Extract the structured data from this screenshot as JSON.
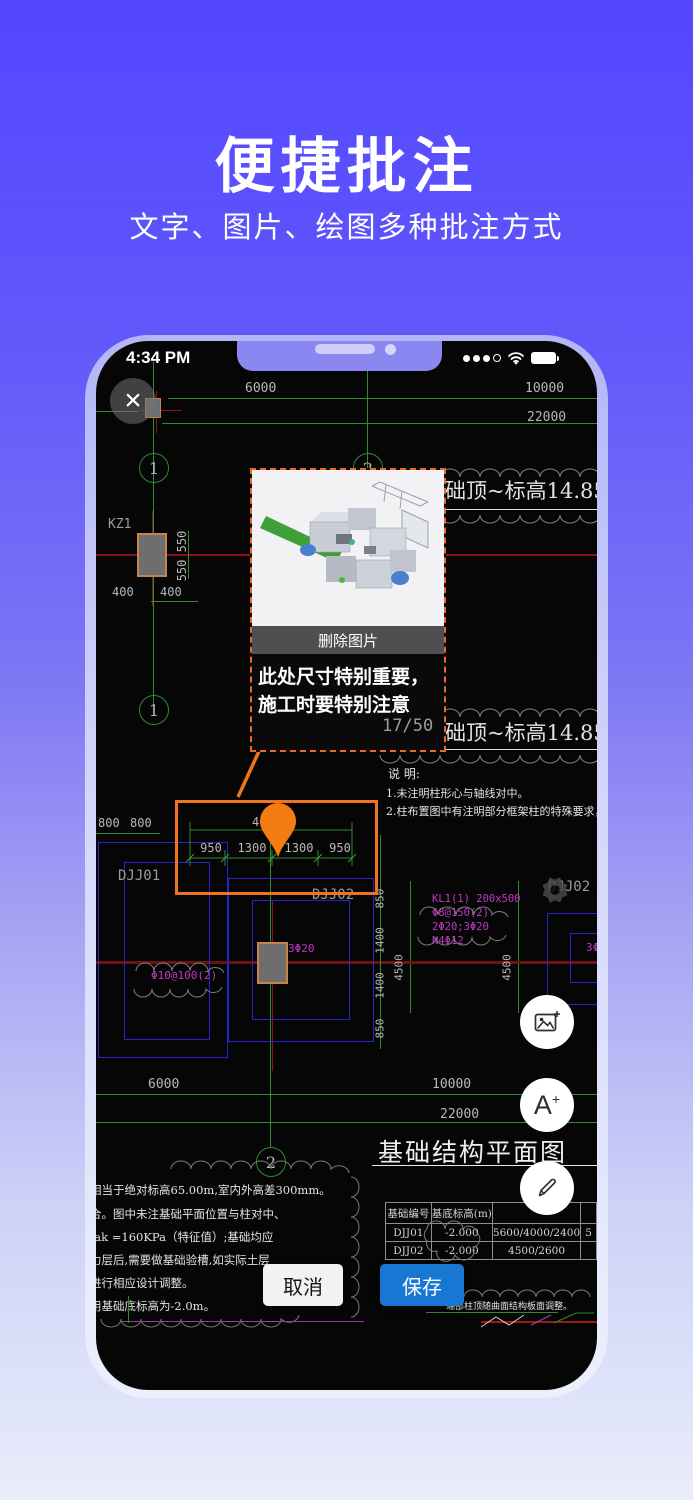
{
  "hero": {
    "title": "便捷批注",
    "subtitle": "文字、图片、绘图多种批注方式"
  },
  "status": {
    "time": "4:34 PM"
  },
  "viewer": {
    "page_indicator": "17/50"
  },
  "popup": {
    "delete_label": "删除图片",
    "note_line1": "此处尺寸特别重要，",
    "note_line2": "施工时要特别注意"
  },
  "actions": {
    "cancel_label": "取消",
    "save_label": "保存"
  },
  "fab": {
    "add_text_a": "A",
    "add_text_plus": "+"
  },
  "cad": {
    "top_dim_1": "6000",
    "top_dim_2": "10000",
    "top_dim_3": "22000",
    "grid_label_1": "1",
    "grid_label_2": "2",
    "kz1_label": "KZ1",
    "dim_550": "550 550",
    "dim_400_l": "400",
    "dim_400_r": "400",
    "elev_note": "标高基础顶~标高14.85",
    "notes_title": "说 明:",
    "note_1": "1.未注明柱形心与轴线对中。",
    "note_2": "2.柱布置图中有注明部分框架柱的特殊要求，应根据特殊要求",
    "dim_800_l": "800",
    "dim_800_r": "800",
    "hl_dim_partial": "4",
    "hl_dims": [
      "950",
      "1300",
      "1300",
      "950"
    ],
    "djj01": "DJJ01",
    "djj02": "DJJ02",
    "djj02_right": "DJJ02",
    "kl1_lines": [
      "KL1(1) 200x500",
      "Φ8@150(2)",
      "2Φ20;3Φ20",
      "N4Φ12"
    ],
    "rebar_3d20": "3Φ20",
    "rebar_3d20_right": "3Φ20",
    "rebar_phi10": "Φ10@100(2)",
    "vdim_850_a": "850",
    "vdim_1400_a": "1400",
    "vdim_1400_b": "1400",
    "vdim_850_b": "850",
    "vdim_4500_l": "4500",
    "vdim_4500_r": "4500",
    "bot_dim_1": "6000",
    "bot_dim_2": "10000",
    "bot_dim_3": "22000",
    "plan_title": "基础结构平面图",
    "table": {
      "headers": [
        "基础编号",
        "基底标高(m)",
        "",
        ""
      ],
      "rows": [
        [
          "DJJ01",
          "-2.000",
          "5600/4000/2400",
          "5"
        ],
        [
          "DJJ02",
          "-2.000",
          "4500/2600",
          ""
        ]
      ]
    },
    "left_notes": [
      "相当于绝对标高65.00m,室内外高差300mm。",
      "合。图中未注基础平面位置与柱对中、",
      "fak =160KPa（特征值）;基础均应",
      "力层后,需要做基础验槽,如实际土层",
      "进行相应设计调整。",
      "用基础底标高为-2.0m。"
    ],
    "br_note": "端部柱顶随曲面结构板面调整。"
  },
  "colors": {
    "accent_orange": "#F0731F",
    "save_blue": "#1877D3",
    "cad_green": "#2E8B2E",
    "cad_red": "#8A1414",
    "cad_dark_red": "#6B1212",
    "cad_blue": "#2525CC",
    "cad_magenta": "#C23AC2",
    "bg_top": "#5347FF",
    "bg_bottom": "#E9EDFA"
  }
}
